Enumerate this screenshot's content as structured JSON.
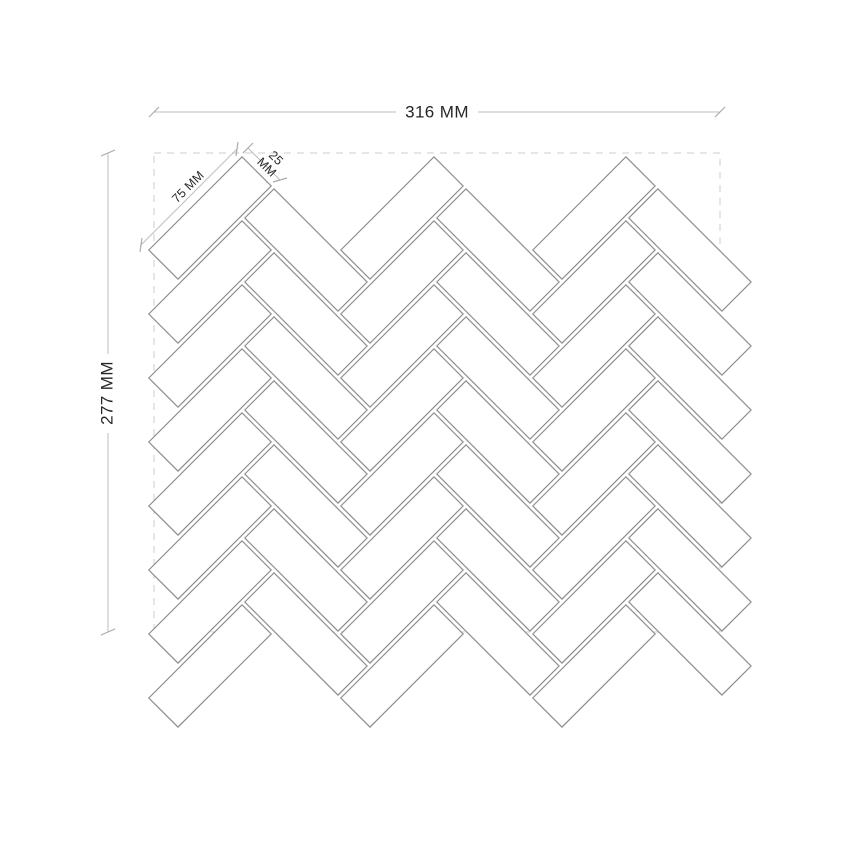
{
  "drawing": {
    "title": "herringbone-mosaic-sheet-dimension-drawing",
    "width_label": "316 MM",
    "height_label": "277 MM",
    "tile_length_label": "75 MM",
    "tile_width_label": "25 MM",
    "sheet_width_mm": 316,
    "sheet_height_mm": 277,
    "tile_length_mm": 75,
    "tile_width_mm": 25
  },
  "pattern": {
    "type": "herringbone-45deg",
    "tile_ratio": 3,
    "columns": 3,
    "rows": 8,
    "unit_px": 45.25,
    "grout_inset_px": 2,
    "k_px": 32.0,
    "origin_x": 146,
    "origin_y": 250
  },
  "sheet": {
    "x": 154,
    "y": 153,
    "width": 566,
    "height": 479
  },
  "colors": {
    "background": "#ffffff",
    "tile_fill": "#ffffff",
    "tile_stroke": "#8d8d8d",
    "sheet_dash": "#d6d6d6",
    "dim_line": "#bdbdbd",
    "dim_tick": "#ababab",
    "text": "#262626"
  }
}
